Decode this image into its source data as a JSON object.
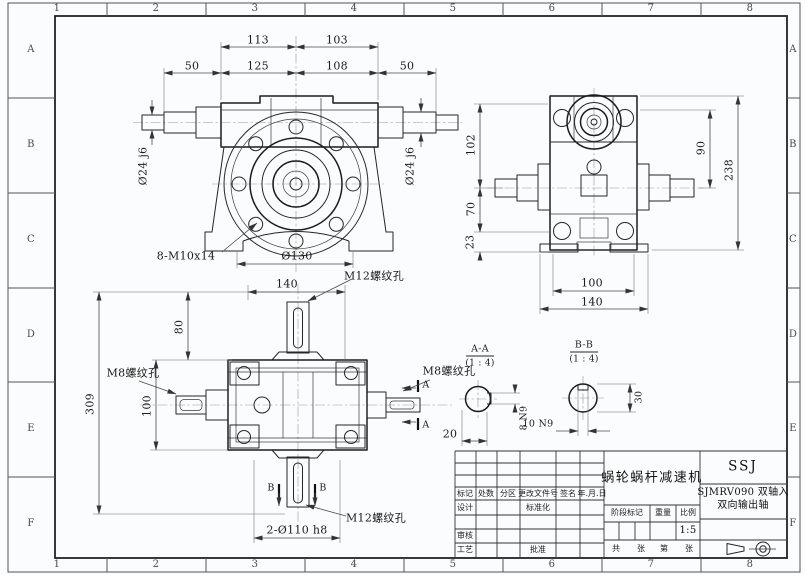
{
  "frame": {
    "cols": [
      "1",
      "2",
      "3",
      "4",
      "5",
      "6",
      "7",
      "8"
    ],
    "rows": [
      "A",
      "B",
      "C",
      "D",
      "E",
      "F"
    ]
  },
  "front_view": {
    "dims": {
      "w_top_left": "113",
      "w_top_right": "103",
      "w_50_left": "50",
      "w_mid_left": "125",
      "w_mid_right": "108",
      "w_50_right": "50",
      "shaft_left": "Ø24 j6",
      "shaft_right": "Ø24 j6",
      "bolt_note": "8-M10x14",
      "flange_dia": "Ø130"
    }
  },
  "side_view": {
    "dims": {
      "h_102": "102",
      "h_70": "70",
      "h_23": "23",
      "h_90": "90",
      "h_238": "238",
      "w_100": "100",
      "w_140": "140"
    }
  },
  "bottom_view": {
    "dims": {
      "w_140": "140",
      "thread_top": "M12螺纹孔",
      "h_80": "80",
      "h_100": "100",
      "h_309": "309",
      "thread_left": "M8螺纹孔",
      "thread_right": "M8螺纹孔",
      "sec_a": "A",
      "sec_b": "B",
      "d_20": "20",
      "bore": "2-Ø110 h8",
      "thread_bottom": "M12螺纹孔"
    }
  },
  "sections": {
    "aa": {
      "title": "A-A",
      "scale": "(1 : 4)",
      "key": "8 N9"
    },
    "bb": {
      "title": "B-B",
      "scale": "(1 : 4)",
      "key": "10 N9",
      "dia": "30"
    }
  },
  "title_block": {
    "product": "蜗轮蜗杆减速机",
    "company": "SSJ",
    "model1": "SJMRV090 双轴入",
    "model2": "双向输出轴",
    "h_mark": "标记",
    "h_count": "处数",
    "h_zone": "分区",
    "h_doc": "更改文件号",
    "h_sign": "签名",
    "h_date": "年.月.日",
    "r_design": "设计",
    "r_std": "标准化",
    "r_check": "审核",
    "r_process": "工艺",
    "r_approve": "批准",
    "stage": "阶段标记",
    "weight": "重量",
    "scale_label": "比例",
    "scale_value": "1:5",
    "total": "共",
    "sheet": "张",
    "no": "第",
    "sheet2": "张"
  }
}
